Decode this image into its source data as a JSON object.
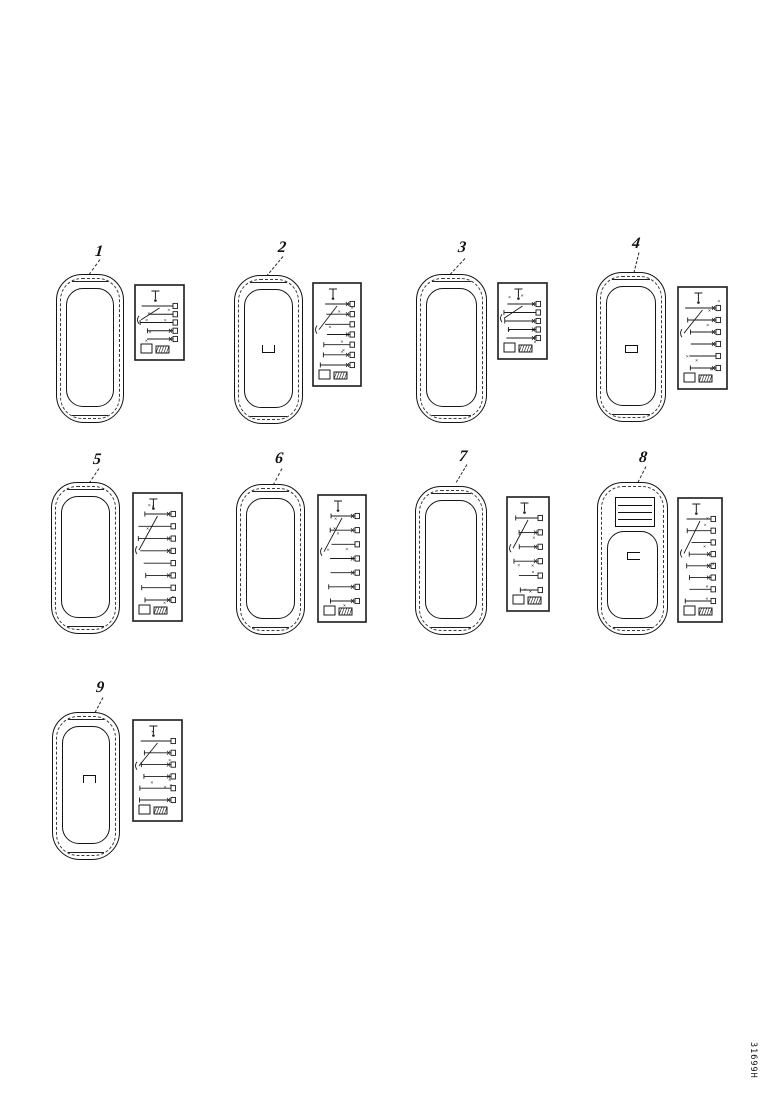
{
  "page": {
    "background": "#ffffff",
    "ink": "#1a1a1a",
    "description": "Parts catalog diagram page: nine vehicle roof top views, each with a callout number and a wiring schematic detail box"
  },
  "figure_code": "31699H",
  "items": [
    {
      "label": "1",
      "roof_marking": "none"
    },
    {
      "label": "2",
      "roof_marking": "bracket-up"
    },
    {
      "label": "3",
      "roof_marking": "none"
    },
    {
      "label": "4",
      "roof_marking": "rectangle"
    },
    {
      "label": "5",
      "roof_marking": "none"
    },
    {
      "label": "6",
      "roof_marking": "none"
    },
    {
      "label": "7",
      "roof_marking": "none"
    },
    {
      "label": "8",
      "roof_marking": "sunroof-and-handle"
    },
    {
      "label": "9",
      "roof_marking": "bracket-down"
    }
  ]
}
